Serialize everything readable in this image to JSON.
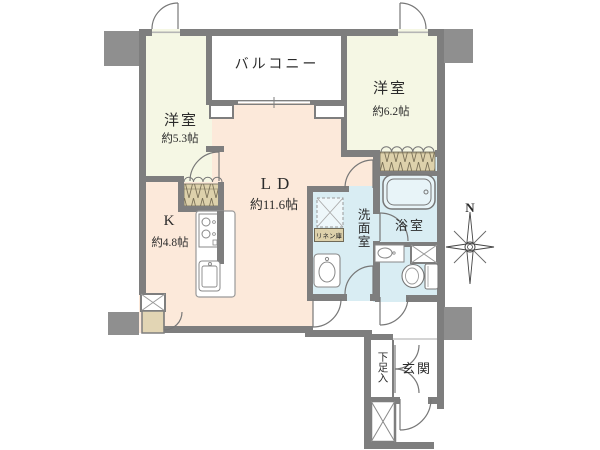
{
  "rooms": {
    "balcony": {
      "name": "バルコニー"
    },
    "bedroom_left": {
      "name": "洋室",
      "size": "約5.3帖"
    },
    "bedroom_right": {
      "name": "洋室",
      "size": "約6.2帖"
    },
    "living_dining": {
      "name": "LD",
      "size": "約11.6帖"
    },
    "kitchen": {
      "name": "K",
      "size": "約4.8帖"
    },
    "washroom": {
      "name": "洗面室"
    },
    "bathroom": {
      "name": "浴室"
    },
    "entrance": {
      "name": "玄関"
    },
    "shoe_cabinet": {
      "name": "下足入"
    },
    "linen_closet": {
      "name": "リネン庫"
    }
  },
  "compass": {
    "north_label": "N"
  },
  "colors": {
    "wall": "#7e7e7e",
    "column_block": "#8f8f8f",
    "bedroom_floor": "#f5f7e4",
    "living_floor": "#fce9da",
    "wet_area_floor": "#d9edf3",
    "closet_fill": "#ddd1ab",
    "storage_fill": "#e2d5b4",
    "bathtub_fill": "#e8f4f8",
    "line": "#777777"
  },
  "icons": {
    "bathtub": "bathtub-icon",
    "toilet": "toilet-icon",
    "washbasin": "washbasin-icon",
    "hand_basin": "hand-basin-icon",
    "washing_machine_pan": "washing-machine-pan-icon",
    "kitchen_stove": "stove-icon",
    "kitchen_sink": "kitchen-sink-icon",
    "meter_box": "meter-box-icon",
    "pipe_space": "pipe-space-icon",
    "compass_star": "compass-star-icon"
  }
}
